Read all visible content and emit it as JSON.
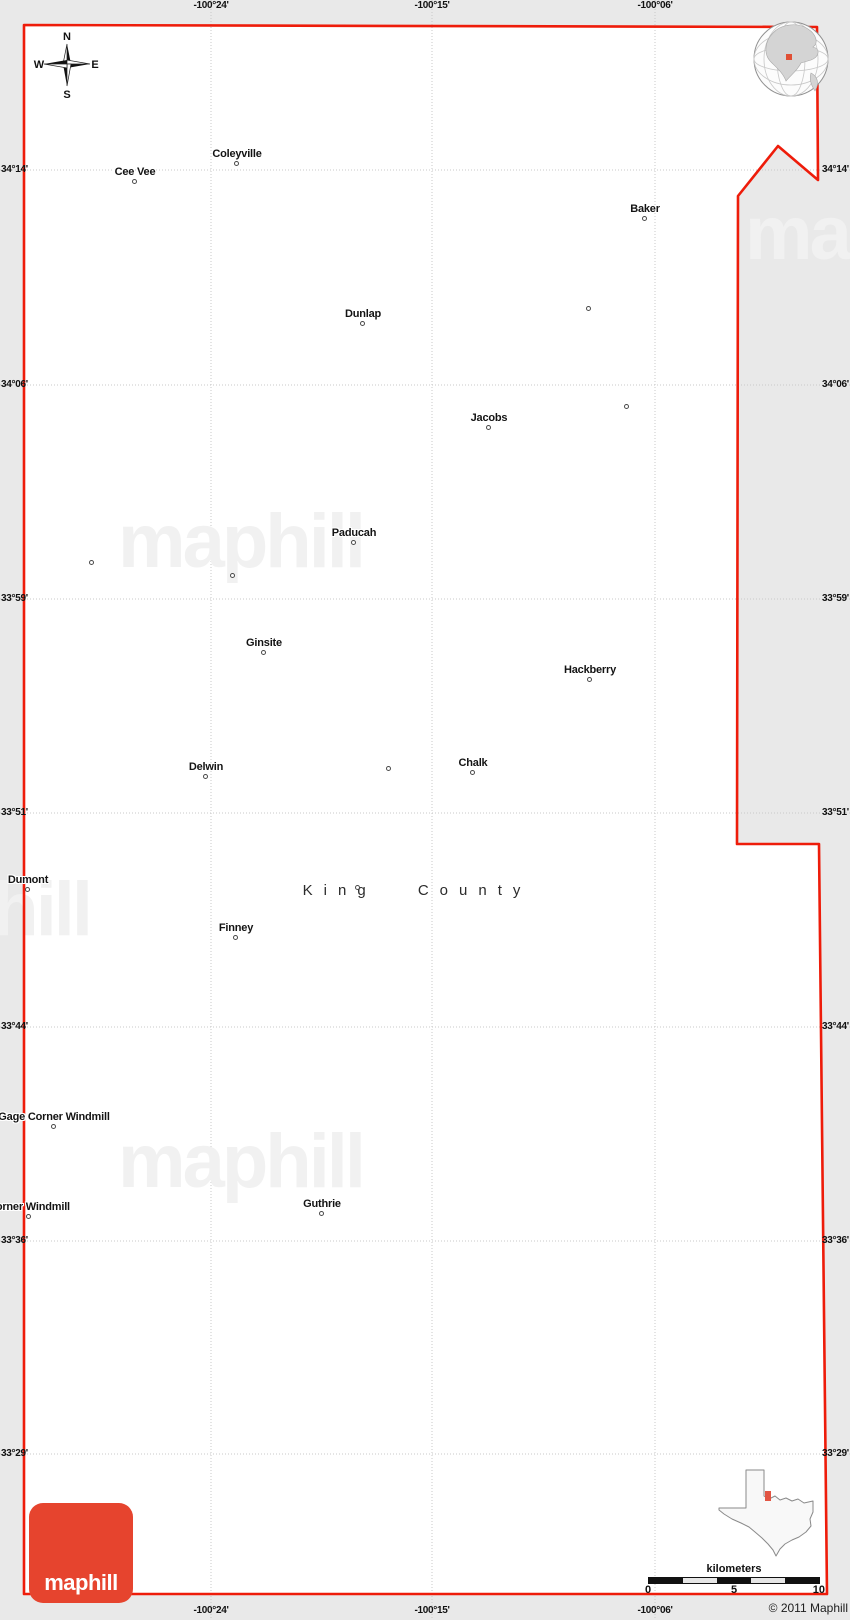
{
  "map": {
    "title": "King County",
    "copyright": "© 2011 Maphill",
    "logo_text": "maphill",
    "watermark_text": "maphill",
    "compass": {
      "n": "N",
      "s": "S",
      "e": "E",
      "w": "W"
    },
    "scale": {
      "label": "kilometers",
      "ticks": [
        "0",
        "5",
        "10"
      ]
    },
    "grid": {
      "meridians": [
        {
          "label": "-100°24'",
          "x": 211
        },
        {
          "label": "-100°15'",
          "x": 432
        },
        {
          "label": "-100°06'",
          "x": 655
        }
      ],
      "parallels": [
        {
          "label": "34°14'",
          "y": 170
        },
        {
          "label": "34°06'",
          "y": 385
        },
        {
          "label": "33°59'",
          "y": 599
        },
        {
          "label": "33°51'",
          "y": 813
        },
        {
          "label": "33°44'",
          "y": 1027
        },
        {
          "label": "33°36'",
          "y": 1241
        },
        {
          "label": "33°29'",
          "y": 1454
        }
      ]
    },
    "border_points": "24,25 817,27 818,180 778,146 738,196 737,844 819,844 827,1594 24,1594",
    "towns": [
      {
        "name": "Cee Vee",
        "x": 135,
        "y": 173
      },
      {
        "name": "Coleyville",
        "x": 237,
        "y": 155
      },
      {
        "name": "Baker",
        "x": 645,
        "y": 210
      },
      {
        "name": "Dunlap",
        "x": 363,
        "y": 315
      },
      {
        "name": "Jacobs",
        "x": 489,
        "y": 419
      },
      {
        "name": "Paducah",
        "x": 354,
        "y": 534
      },
      {
        "name": "Ginsite",
        "x": 264,
        "y": 644
      },
      {
        "name": "Hackberry",
        "x": 590,
        "y": 671
      },
      {
        "name": "Delwin",
        "x": 206,
        "y": 768
      },
      {
        "name": "Chalk",
        "x": 473,
        "y": 764
      },
      {
        "name": "Dumont",
        "x": 28,
        "y": 881
      },
      {
        "name": "Finney",
        "x": 236,
        "y": 929
      },
      {
        "name": "Gage Corner Windmill",
        "x": 54,
        "y": 1118
      },
      {
        "name": "Corner Windmill",
        "x": 29,
        "y": 1208
      },
      {
        "name": "Guthrie",
        "x": 322,
        "y": 1205
      }
    ],
    "unnamed_dots": [
      {
        "x": 589,
        "y": 309
      },
      {
        "x": 627,
        "y": 407
      },
      {
        "x": 92,
        "y": 563
      },
      {
        "x": 233,
        "y": 576
      },
      {
        "x": 389,
        "y": 769
      },
      {
        "x": 358,
        "y": 888
      }
    ],
    "colors": {
      "border": "#ee1c0a",
      "logo": "#e6442e",
      "margin": "#e9e9e9",
      "grid": "#c9c9c9",
      "watermark": "#f1f1f1",
      "inset_marker": "#e25544"
    }
  }
}
